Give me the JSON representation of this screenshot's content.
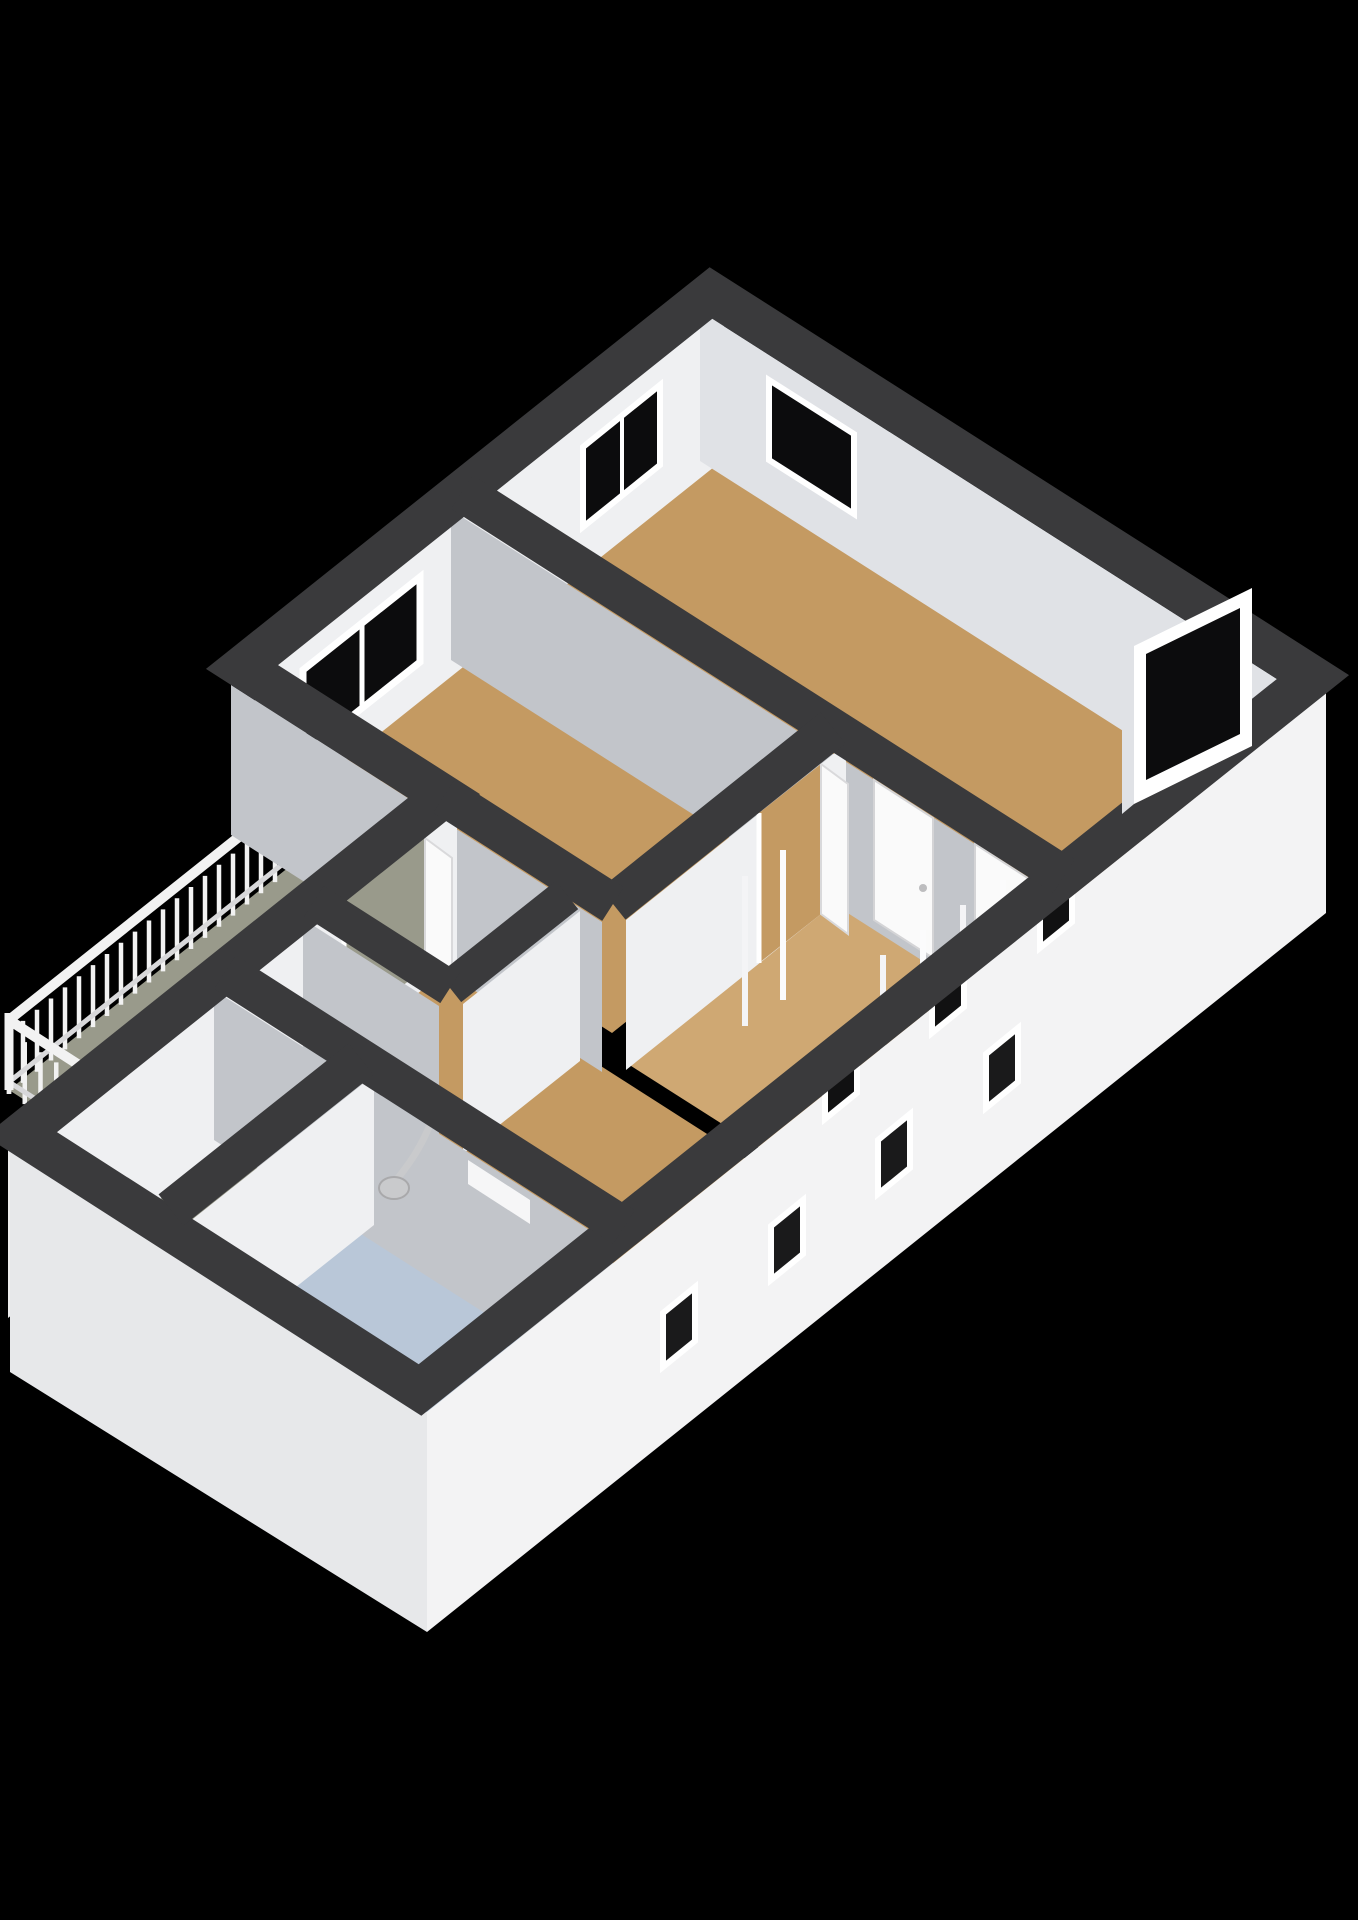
{
  "meta": {
    "view": "3d-floorplan-cutaway",
    "description": "Isometric dollhouse render of an apartment floor on a black background"
  },
  "colors": {
    "background": "#000000",
    "wall_top": "#3a3a3c",
    "wall_face_light": "#eff0f2",
    "wall_face_bright": "#f6f6f7",
    "wall_face_shaded": "#c2c5ca",
    "wall_face_mid": "#e0e2e6",
    "facade": "#f3f3f4",
    "facade_shaded": "#e7e8ea",
    "facade_step": "#ededee",
    "floor_wood": "#c49a62",
    "floor_wood_light": "#cfa873",
    "floor_balcony": "#999a8b",
    "floor_storage": "#8f9080",
    "floor_bathroom": "#b9c7d8",
    "window_glass": "#0c0c0d",
    "window_frame": "#ffffff",
    "door_panel": "#fafafa",
    "door_frame": "#e3e3e5",
    "railing": "#f2f2f2",
    "railing_shadow": "#d8d8da",
    "fixture_metal": "#c9cacc"
  },
  "rooms": [
    {
      "id": "bedroom-ne",
      "floor": "wood"
    },
    {
      "id": "bedroom-mid",
      "floor": "wood"
    },
    {
      "id": "corridor",
      "floor": "wood"
    },
    {
      "id": "hall",
      "floor": "wood"
    },
    {
      "id": "storage",
      "floor": "storage"
    },
    {
      "id": "bathroom",
      "floor": "bathroom"
    },
    {
      "id": "balcony",
      "floor": "balcony"
    }
  ],
  "counts": {
    "interior_windows": 3,
    "facade_windows": 7,
    "doors": 4,
    "shower_heads": 1
  },
  "railing": {
    "baluster_drop": 62,
    "segments": [
      {
        "x1": 289,
        "y1": 803,
        "x2": 9,
        "y2": 1026,
        "count": 21
      },
      {
        "x1": 9,
        "y1": 1026,
        "x2": 135,
        "y2": 1107,
        "count": 9
      }
    ]
  }
}
